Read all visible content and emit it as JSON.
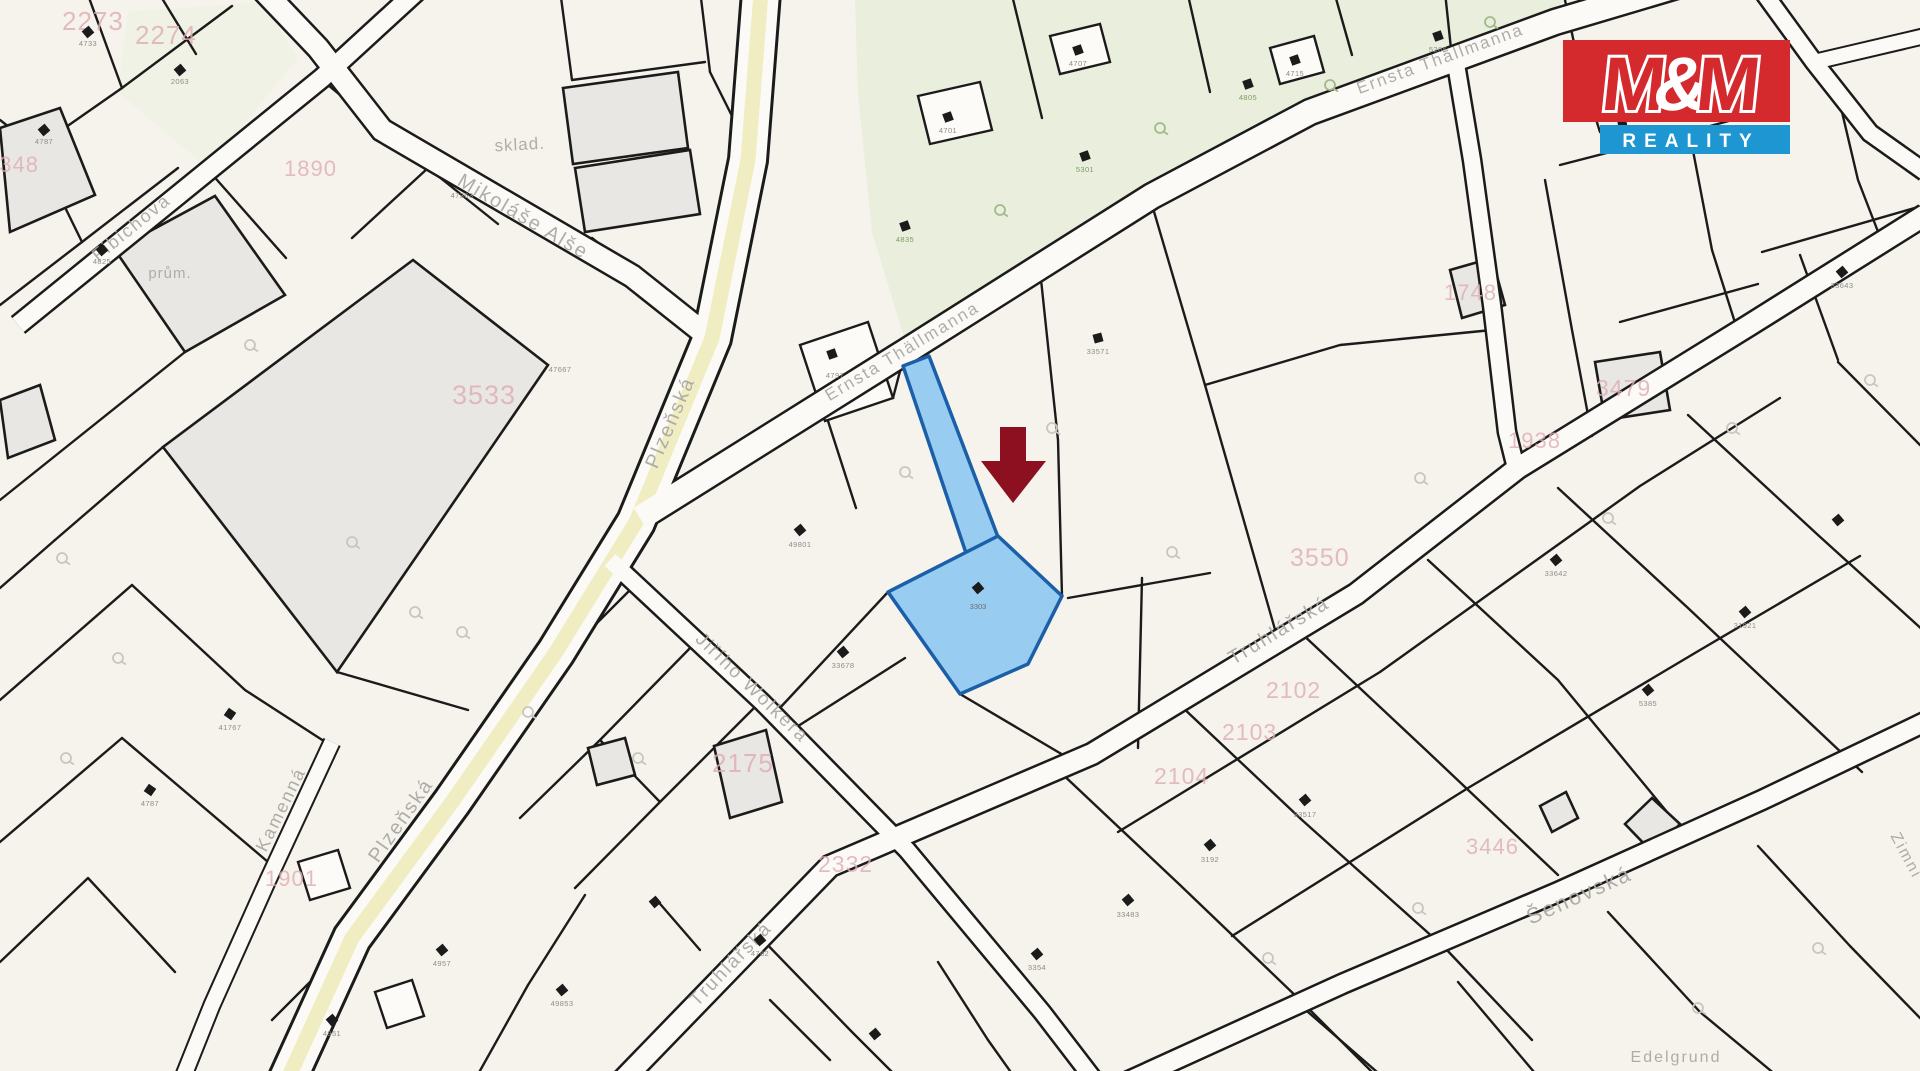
{
  "window": {
    "width": 1920,
    "height": 1071,
    "description": "Cadastral map extract with highlighted parcel and location arrow"
  },
  "logo": {
    "parts": [
      "M",
      "&",
      "M"
    ],
    "reality": "REALITY"
  },
  "colors": {
    "bg": "#f5f3ec",
    "line": "#1b1b1b",
    "green": "#e9efdc",
    "greenSoft": "#f0f2e6",
    "building": "#e8e7e3",
    "road": "#fbfaf6",
    "roadYellow": "#f1edc3",
    "streetLabel": "#a9a7a2",
    "pinkLabel": "#dfadb3",
    "microLabel": "#8f8d89",
    "iconCircle": "#c9c6c0",
    "iconGreen": "#a3b98a",
    "highlightFill": "#98ccf0",
    "highlightStroke": "#1a5fa8",
    "arrow": "#8d1020",
    "logoRed": "#d42a2e",
    "logoBlue": "#1e96d2"
  },
  "map": {
    "streets": [
      {
        "name": "Fibichova"
      },
      {
        "name": "Mikoláše Alše"
      },
      {
        "name": "Plzeňská"
      },
      {
        "name": "Plzeňská"
      },
      {
        "name": "Ernsta Thällmanna"
      },
      {
        "name": "Ernsta Thällmanna"
      },
      {
        "name": "Jiřího Wolkera"
      },
      {
        "name": "Truhlářská"
      },
      {
        "name": "Truhlářská"
      },
      {
        "name": "Kamenná"
      },
      {
        "name": "Šenovská"
      },
      {
        "name": "Edelgrund"
      },
      {
        "name": "Zimní"
      }
    ],
    "area_labels": [
      {
        "text": "sklad."
      },
      {
        "text": "prům."
      }
    ],
    "pink_parcels": [
      {
        "text": "2273"
      },
      {
        "text": "2274"
      },
      {
        "text": "1890"
      },
      {
        "text": "2348"
      },
      {
        "text": "3533"
      },
      {
        "text": "2175"
      },
      {
        "text": "2332"
      },
      {
        "text": "3550"
      },
      {
        "text": "2102"
      },
      {
        "text": "2103"
      },
      {
        "text": "2104"
      },
      {
        "text": "1748"
      },
      {
        "text": "1938"
      },
      {
        "text": "3479"
      },
      {
        "text": "3446"
      },
      {
        "text": "1901"
      }
    ],
    "highlight": {
      "parcel_label": "3303"
    },
    "black_icons": [
      {
        "x": 88,
        "y": 32,
        "r": -40
      },
      {
        "x": 180,
        "y": 70,
        "r": -40
      },
      {
        "x": 44,
        "y": 130,
        "r": -40
      },
      {
        "x": 102,
        "y": 250,
        "r": -40
      },
      {
        "x": 832,
        "y": 354,
        "r": -20
      },
      {
        "x": 800,
        "y": 530,
        "r": -40
      },
      {
        "x": 843,
        "y": 652,
        "r": -40
      },
      {
        "x": 1098,
        "y": 338,
        "r": -15
      },
      {
        "x": 948,
        "y": 117,
        "r": -20
      },
      {
        "x": 1078,
        "y": 50,
        "r": -20
      },
      {
        "x": 1295,
        "y": 60,
        "r": -20
      },
      {
        "x": 1438,
        "y": 36,
        "r": -20
      },
      {
        "x": 1622,
        "y": 122,
        "r": -12
      },
      {
        "x": 1842,
        "y": 272,
        "r": -40
      },
      {
        "x": 1556,
        "y": 560,
        "r": -40
      },
      {
        "x": 1648,
        "y": 690,
        "r": -40
      },
      {
        "x": 1745,
        "y": 612,
        "r": -40
      },
      {
        "x": 1838,
        "y": 520,
        "r": -40
      },
      {
        "x": 1305,
        "y": 800,
        "r": -40
      },
      {
        "x": 1210,
        "y": 845,
        "r": -40
      },
      {
        "x": 1128,
        "y": 900,
        "r": -40
      },
      {
        "x": 1037,
        "y": 954,
        "r": -40
      },
      {
        "x": 875,
        "y": 1034,
        "r": -40
      },
      {
        "x": 760,
        "y": 940,
        "r": -40
      },
      {
        "x": 655,
        "y": 902,
        "r": -40
      },
      {
        "x": 562,
        "y": 990,
        "r": -40
      },
      {
        "x": 332,
        "y": 1020,
        "r": -40
      },
      {
        "x": 442,
        "y": 950,
        "r": -40
      },
      {
        "x": 230,
        "y": 714,
        "r": -55
      },
      {
        "x": 150,
        "y": 790,
        "r": -55
      },
      {
        "x": 905,
        "y": 226,
        "r": -20
      },
      {
        "x": 1085,
        "y": 156,
        "r": -20
      },
      {
        "x": 1248,
        "y": 84,
        "r": -20
      }
    ],
    "circle_icons": [
      {
        "x": 250,
        "y": 345
      },
      {
        "x": 352,
        "y": 542
      },
      {
        "x": 462,
        "y": 632
      },
      {
        "x": 638,
        "y": 758
      },
      {
        "x": 905,
        "y": 472
      },
      {
        "x": 1052,
        "y": 428
      },
      {
        "x": 1172,
        "y": 552
      },
      {
        "x": 1420,
        "y": 478
      },
      {
        "x": 1608,
        "y": 518
      },
      {
        "x": 1732,
        "y": 428
      },
      {
        "x": 1870,
        "y": 380
      },
      {
        "x": 1268,
        "y": 958
      },
      {
        "x": 1418,
        "y": 908
      },
      {
        "x": 1698,
        "y": 1008
      },
      {
        "x": 1818,
        "y": 948
      },
      {
        "x": 62,
        "y": 558
      },
      {
        "x": 118,
        "y": 658
      },
      {
        "x": 66,
        "y": 758
      },
      {
        "x": 528,
        "y": 712
      },
      {
        "x": 415,
        "y": 612
      },
      {
        "x": 1000,
        "y": 210,
        "g": 1
      },
      {
        "x": 1160,
        "y": 128,
        "g": 1
      },
      {
        "x": 1330,
        "y": 85,
        "g": 1
      },
      {
        "x": 1490,
        "y": 22,
        "g": 1
      }
    ],
    "micro_labels": [
      {
        "x": 88,
        "y": 46,
        "t": "4733"
      },
      {
        "x": 180,
        "y": 84,
        "t": "2063"
      },
      {
        "x": 44,
        "y": 144,
        "t": "4787"
      },
      {
        "x": 102,
        "y": 264,
        "t": "4825"
      },
      {
        "x": 462,
        "y": 198,
        "t": "47363"
      },
      {
        "x": 560,
        "y": 372,
        "t": "47667"
      },
      {
        "x": 835,
        "y": 378,
        "t": "4797"
      },
      {
        "x": 800,
        "y": 547,
        "t": "49801"
      },
      {
        "x": 843,
        "y": 668,
        "t": "33678"
      },
      {
        "x": 1098,
        "y": 354,
        "t": "33571"
      },
      {
        "x": 905,
        "y": 242,
        "t": "4835",
        "g": 1
      },
      {
        "x": 1085,
        "y": 172,
        "t": "5301",
        "g": 1
      },
      {
        "x": 1248,
        "y": 100,
        "t": "4805",
        "g": 1
      },
      {
        "x": 948,
        "y": 133,
        "t": "4701"
      },
      {
        "x": 1078,
        "y": 66,
        "t": "4707"
      },
      {
        "x": 1295,
        "y": 76,
        "t": "4715"
      },
      {
        "x": 1438,
        "y": 52,
        "t": "5265"
      },
      {
        "x": 1622,
        "y": 138,
        "t": "33691"
      },
      {
        "x": 1842,
        "y": 288,
        "t": "33643"
      },
      {
        "x": 1556,
        "y": 576,
        "t": "33642"
      },
      {
        "x": 1648,
        "y": 706,
        "t": "5385"
      },
      {
        "x": 1745,
        "y": 628,
        "t": "31921"
      },
      {
        "x": 1305,
        "y": 817,
        "t": "33517"
      },
      {
        "x": 1210,
        "y": 862,
        "t": "3192"
      },
      {
        "x": 1128,
        "y": 917,
        "t": "33483"
      },
      {
        "x": 760,
        "y": 956,
        "t": "4762"
      },
      {
        "x": 562,
        "y": 1006,
        "t": "49853"
      },
      {
        "x": 332,
        "y": 1036,
        "t": "4951"
      },
      {
        "x": 442,
        "y": 966,
        "t": "4957"
      },
      {
        "x": 230,
        "y": 730,
        "t": "41767"
      },
      {
        "x": 150,
        "y": 806,
        "t": "4787"
      },
      {
        "x": 1037,
        "y": 970,
        "t": "3354"
      }
    ]
  }
}
